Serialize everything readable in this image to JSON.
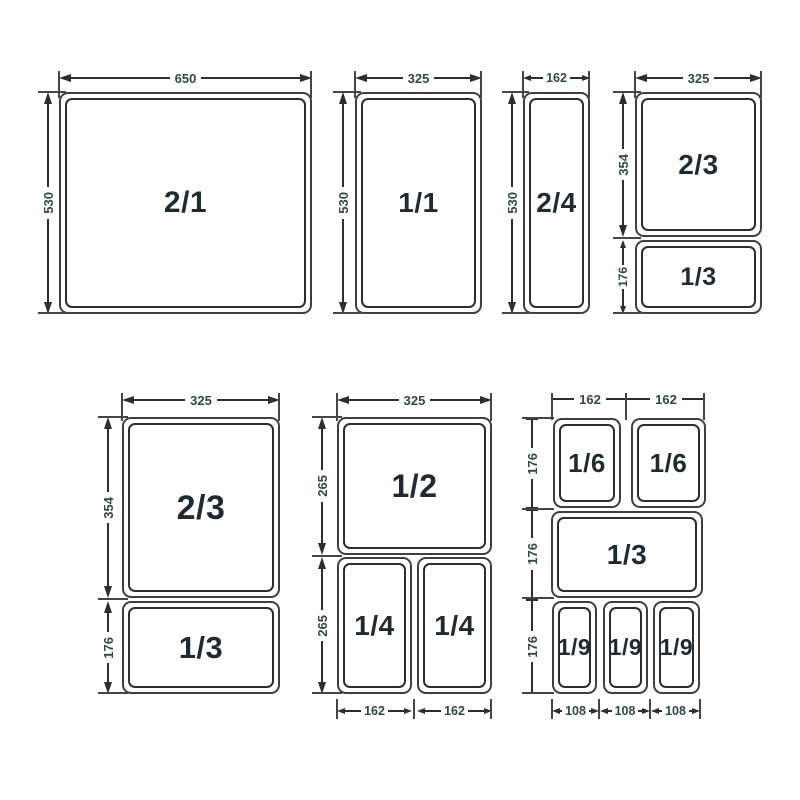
{
  "colors": {
    "line": "#2e2e2e",
    "dim_text": "#2f4a49",
    "pan_text": "#1f2a31",
    "background": "#ffffff"
  },
  "diagram": "gastronorm-pan-size-chart",
  "groups": [
    {
      "id": "2-1",
      "pans": [
        {
          "label": "2/1"
        }
      ],
      "dims": {
        "top": "650",
        "left": "530"
      }
    },
    {
      "id": "1-1",
      "pans": [
        {
          "label": "1/1"
        }
      ],
      "dims": {
        "top": "325",
        "left": "530"
      }
    },
    {
      "id": "2-4",
      "pans": [
        {
          "label": "2/4"
        }
      ],
      "dims": {
        "top": "162",
        "left": "530"
      }
    },
    {
      "id": "2-3-1-3-upper",
      "pans": [
        {
          "label": "2/3"
        },
        {
          "label": "1/3"
        }
      ],
      "dims": {
        "top": "325",
        "left_upper": "354",
        "left_lower": "176"
      }
    },
    {
      "id": "2-3-1-3-lower",
      "pans": [
        {
          "label": "2/3"
        },
        {
          "label": "1/3"
        }
      ],
      "dims": {
        "top": "325",
        "left_upper": "354",
        "left_lower": "176"
      }
    },
    {
      "id": "1-2-1-4",
      "pans": [
        {
          "label": "1/2"
        },
        {
          "label": "1/4"
        },
        {
          "label": "1/4"
        }
      ],
      "dims": {
        "top": "325",
        "left_upper": "265",
        "left_lower": "265",
        "bottom_left": "162",
        "bottom_right": "162"
      }
    },
    {
      "id": "1-6-1-3-1-9",
      "pans": [
        {
          "label": "1/6"
        },
        {
          "label": "1/6"
        },
        {
          "label": "1/3"
        },
        {
          "label": "1/9"
        },
        {
          "label": "1/9"
        },
        {
          "label": "1/9"
        }
      ],
      "dims": {
        "top_left": "162",
        "top_right": "162",
        "left_1": "176",
        "left_2": "176",
        "left_3": "176",
        "bottom_1": "108",
        "bottom_2": "108",
        "bottom_3": "108"
      }
    }
  ]
}
